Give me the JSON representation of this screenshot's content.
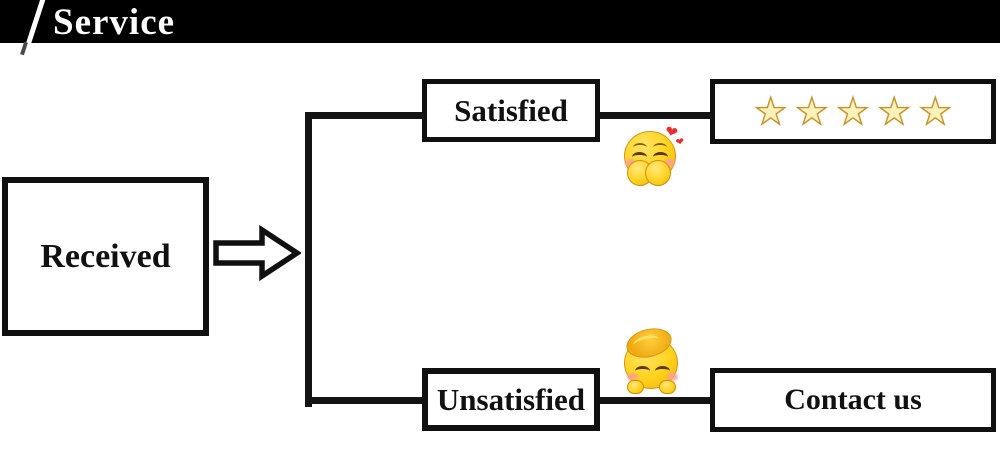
{
  "header": {
    "title": "Service"
  },
  "flow": {
    "received_label": "Received",
    "satisfied_label": "Satisfied",
    "unsatisfied_label": "Unsatisfied",
    "contact_label": "Contact us",
    "rating": {
      "count": 5,
      "glyph": "★"
    }
  },
  "icons": {
    "arrow": "right-block-arrow",
    "emoji_top": "giggling-covering-mouth-emoji",
    "emoji_bottom": "shy-peeking-emoji",
    "star": "five-star-rating"
  },
  "colors": {
    "banner_bg": "#000000",
    "line": "#141414",
    "box_border": "#101010",
    "star_fill": "#fbf2ba",
    "star_stroke": "#c6922f",
    "emoji_yellow": "#ffd21c",
    "heart_red": "#e62e2e"
  }
}
